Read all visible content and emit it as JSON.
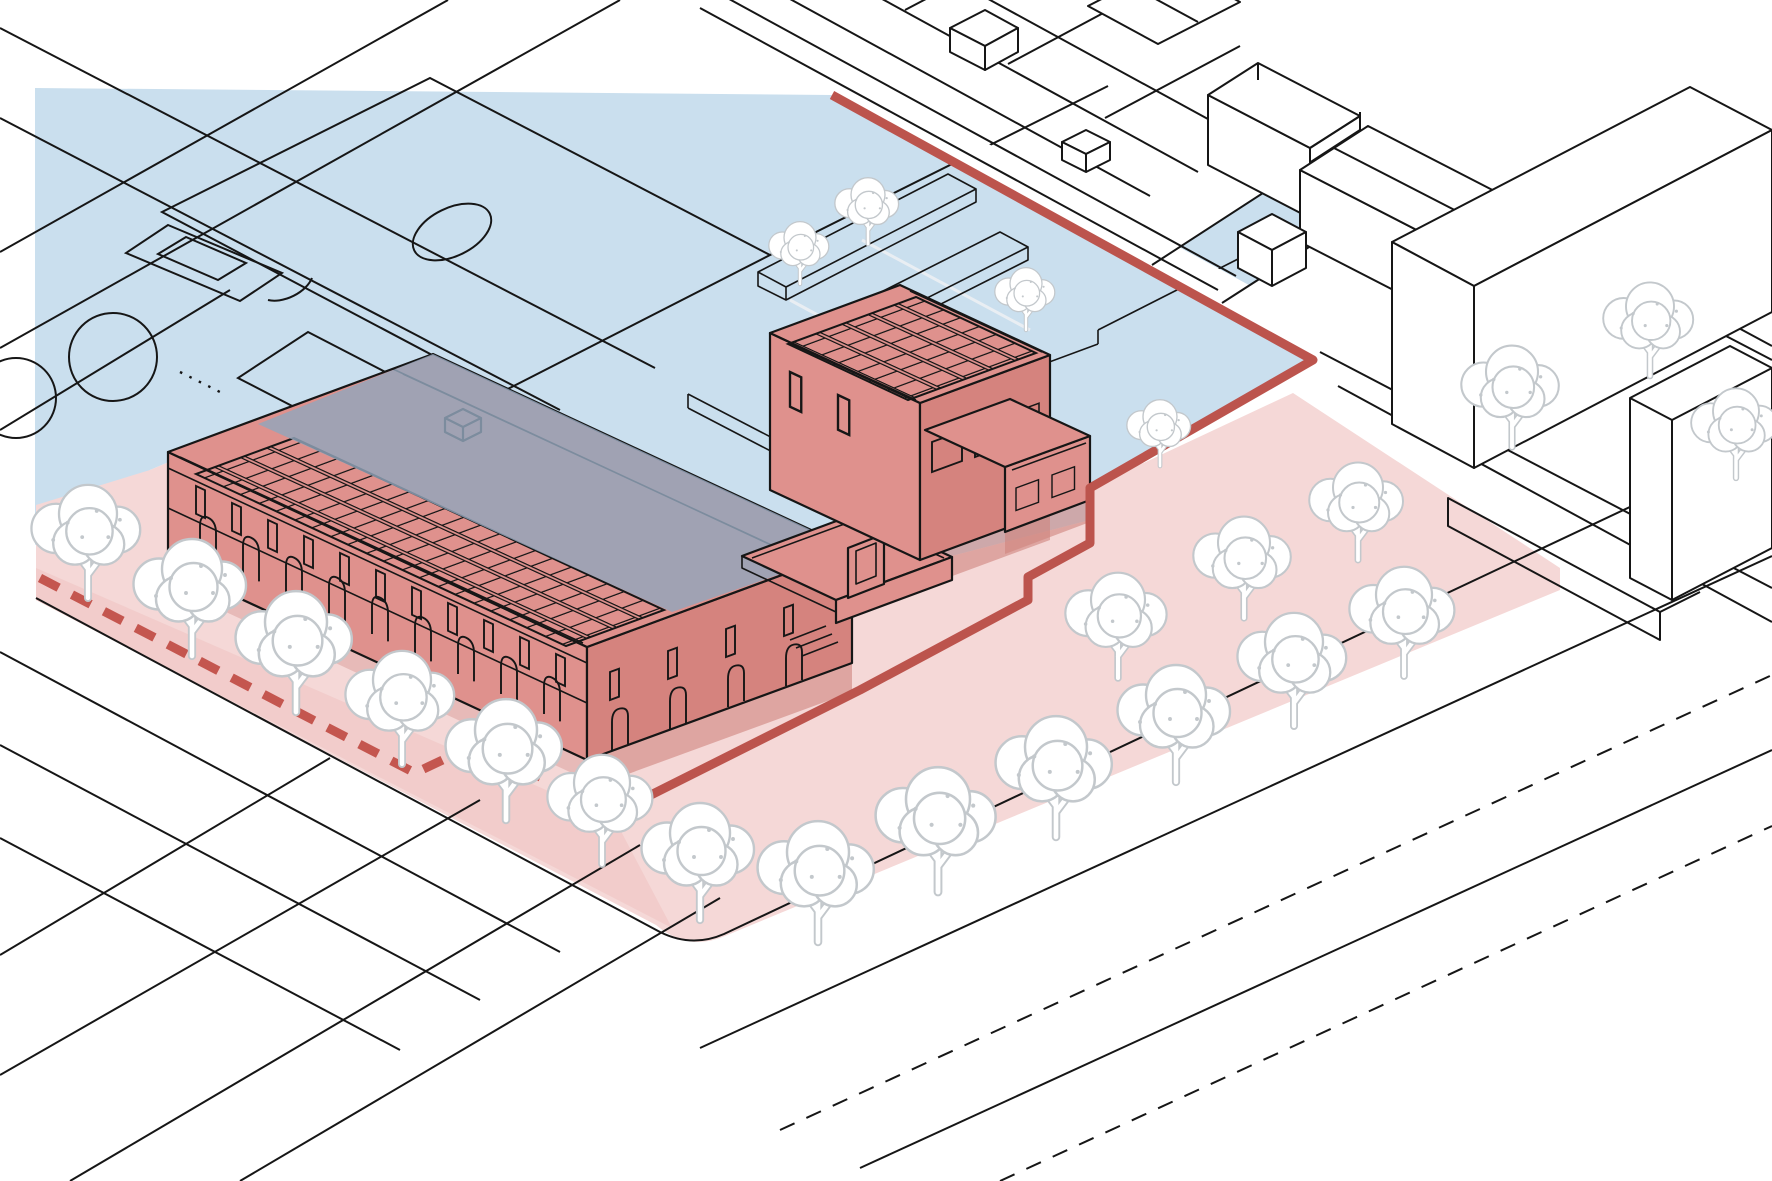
{
  "diagram": {
    "kind": "architectural axonometric site diagram",
    "description": "Isometric urban site drawing of a school complex with rooftop solar panels; a light blue overlay marks the northern zone (sports fields, courtyard) and a light pink overlay marks the southern zone; a thick red solid line traces the site boundary and a red dashed line runs along the street-front sidewalk; white line-drawn neighbouring blocks sit to the upper right and white trees line the streets.",
    "zones": [
      {
        "id": "blue-zone",
        "role": "north site area overlay",
        "color": "#cadfee"
      },
      {
        "id": "pink-zone",
        "role": "south site area overlay",
        "color": "#f5d8d7"
      }
    ],
    "boundary": {
      "solid_line_color": "#bc544d",
      "dashed_line_color": "#c4564f",
      "solid_line_width_px": 9,
      "dashed_line_width_px": 9
    },
    "building": {
      "fill": "#df918d",
      "shaded_face_fill": "#d5837e",
      "roof_under_blue_overlay": "#92a6bc",
      "features": [
        "rooftop solar panel arrays",
        "arcade with arched openings",
        "tall stair tower",
        "roof terrace with parapet",
        "one-storey east wing"
      ]
    },
    "environment": {
      "tree_count": 23,
      "street_line_color": "#161616",
      "sports_fields": [
        "soccer field with penalty boxes",
        "small court",
        "circular markings"
      ],
      "neighbour_blocks": [
        "terraced row housing plinth",
        "gabled houses",
        "large flat-roof halls",
        "small cubic volumes"
      ]
    }
  },
  "colors": {
    "zone_blue": "#cadfee",
    "zone_pink": "#f5d8d7",
    "zone_pink_mid": "#efc3c1",
    "roof_slate": "#92a6bc",
    "building_salmon": "#df918d",
    "building_salmon_dark": "#d5837e",
    "building_shadow": "#cf837d",
    "boundary_red": "#bc544d",
    "boundary_dash_red": "#c4564f",
    "line_black": "#161616",
    "tree_outline": "#c3c8cc",
    "white": "#ffffff"
  }
}
